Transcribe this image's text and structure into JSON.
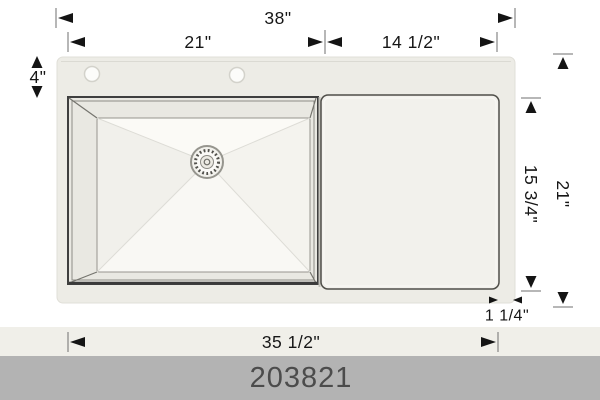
{
  "diagram": {
    "description": "Top view dimension drawing of a single-bowl kitchen sink with right-side drainboard, two faucet holes and center drain",
    "dims": {
      "overall_width": "38\"",
      "bowl_width": "21\"",
      "drainboard_width": "14 1/2\"",
      "deck_depth": "4\"",
      "drainboard_depth": "15 3/4\"",
      "overall_depth": "21\"",
      "edge_offset": "1 1/4\"",
      "inner_width": "35 1/2\""
    },
    "features": {
      "faucet_hole_count": 2,
      "drain_count": 1
    }
  },
  "footer": {
    "model_number": "203821"
  },
  "colors": {
    "deck": "#edece6",
    "drainboard": "#f2f1ec",
    "bowl_floor": "#f7f6f2",
    "outline": "#3f3f3f",
    "dimension_ink": "#141414",
    "band": "#f0efe9",
    "footer_bar": "#b3b3b3",
    "footer_text": "#4c4c4c"
  }
}
